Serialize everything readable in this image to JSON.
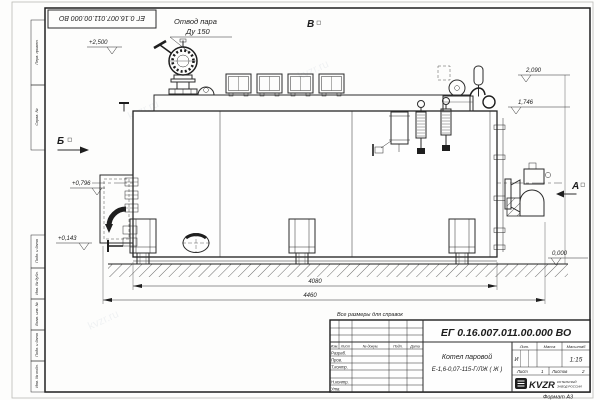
{
  "sheet": {
    "ref_number": "ЕГ 0.16.007.011.00.000 ВО",
    "format_label": "Формат А3",
    "watermark": "kvzr.ru",
    "stamps_top": [
      "Перв. примен.",
      "Справ. №"
    ],
    "stamps_bottom": [
      "Подп. и дата",
      "Инв. № дубл.",
      "Взам. инв. №",
      "Подп. и дата",
      "Инв. № подл."
    ]
  },
  "drawing": {
    "callout_line1": "Отвод пара",
    "callout_line2": "Ду 150",
    "views": {
      "b": "Б",
      "v": "В",
      "a": "А"
    },
    "levels": [
      "+2,500",
      "2,090",
      "1,746",
      "+0,796",
      "+0,143",
      "0,000"
    ],
    "dimensions": [
      "4080",
      "4460"
    ],
    "note": "Все размеры для справок"
  },
  "title_block": {
    "doc_number": "ЕГ 0.16.007.011.00.000  ВО",
    "product_name": "Котел паровой",
    "product_model": "Е-1,6-0,07-115-Г/ЛЖ ( Ж )",
    "cols": [
      "Изм.",
      "Лист",
      "№ докум.",
      "Подп.",
      "Дата"
    ],
    "rows": [
      "Разраб.",
      "Пров.",
      "Т.контр.",
      "Н.контр.",
      "Утв."
    ],
    "lit_label": "Лит.",
    "lit_value": "И",
    "mass_label": "Масса",
    "scale_label": "Масштаб",
    "scale_value": "1:15",
    "sheet_label": "Лист",
    "sheet_value": "1",
    "sheets_label": "Листов",
    "sheets_value": "2",
    "company_logo": "KVZR",
    "company_line1": "КОТЕЛЬНЫЙ",
    "company_line2": "ЗАВОД РОССИИ"
  }
}
